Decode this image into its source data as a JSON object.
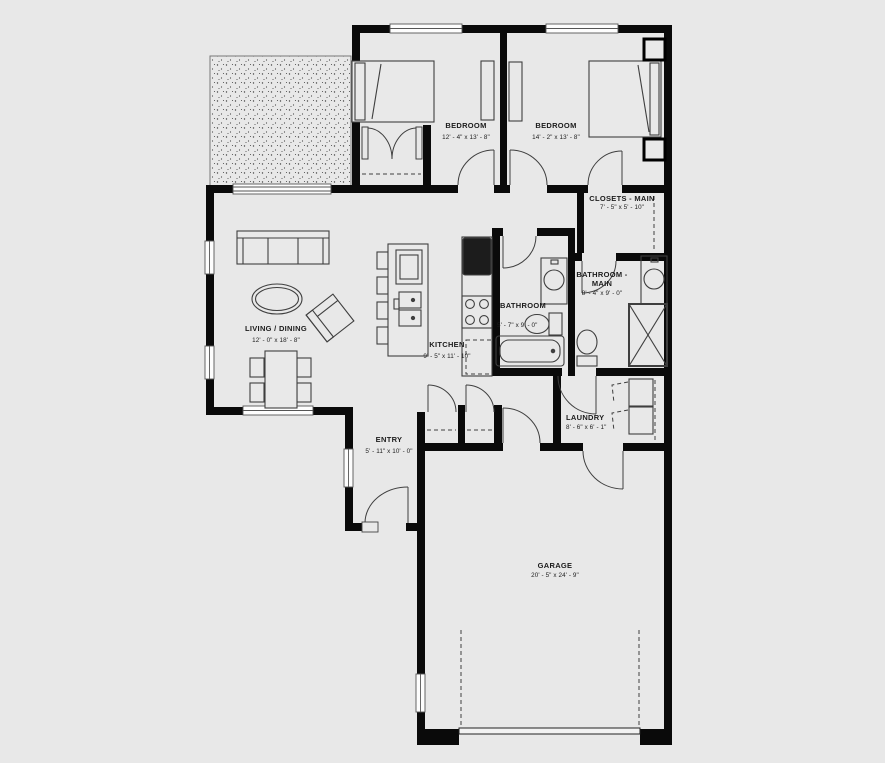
{
  "colors": {
    "background": "#e8e8e8",
    "walls": "#0a0a0a",
    "lines": "#3f3f3f"
  },
  "rooms": [
    {
      "id": "living_dining",
      "name": "LIVING / DINING",
      "dims": "12' - 0\" x 18' - 8\""
    },
    {
      "id": "kitchen",
      "name": "KITCHEN",
      "dims": "9' - 5\" x 11' - 10\""
    },
    {
      "id": "bathroom",
      "name": "BATHROOM",
      "dims": "5' - 7\" x 9' - 0\""
    },
    {
      "id": "bathroom_main",
      "name": "BATHROOM - MAIN",
      "dims": "8' - 4\" x 9' - 0\""
    },
    {
      "id": "closets_main",
      "name": "CLOSETS - MAIN",
      "dims": "7' - 5\" x 5' - 10\""
    },
    {
      "id": "bedroom_1",
      "name": "BEDROOM",
      "dims": "12' - 4\" x 13' - 8\""
    },
    {
      "id": "bedroom_2",
      "name": "BEDROOM",
      "dims": "14' - 2\" x 13' - 8\""
    },
    {
      "id": "entry",
      "name": "ENTRY",
      "dims": "5' - 11\" x 10' - 0\""
    },
    {
      "id": "laundry",
      "name": "LAUNDRY",
      "dims": "8' - 6\" x 6' - 1\""
    },
    {
      "id": "garage",
      "name": "GARAGE",
      "dims": "20' - 5\" x 24' - 9\""
    }
  ]
}
